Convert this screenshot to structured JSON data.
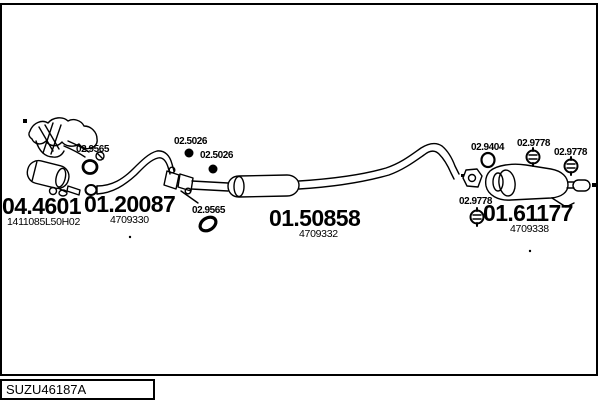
{
  "window": {
    "background": "#ffffff",
    "line_color": "#000000"
  },
  "diagram": {
    "type": "exhaust-system-parts-diagram",
    "parts": [
      {
        "code": "04.4601",
        "ref": "1411085L50H02"
      },
      {
        "code": "01.20087",
        "ref": "4709330"
      },
      {
        "code": "01.50858",
        "ref": "4709332"
      },
      {
        "code": "01.61177",
        "ref": "4709338"
      }
    ],
    "fittings": [
      {
        "code": "02.5026"
      },
      {
        "code": "02.5026"
      },
      {
        "code": "02.9565"
      },
      {
        "code": "02.9565"
      },
      {
        "code": "02.9404"
      },
      {
        "code": "02.9778"
      },
      {
        "code": "02.9778"
      },
      {
        "code": "02.9778"
      }
    ]
  },
  "footer": {
    "code": "SUZU46187A"
  }
}
